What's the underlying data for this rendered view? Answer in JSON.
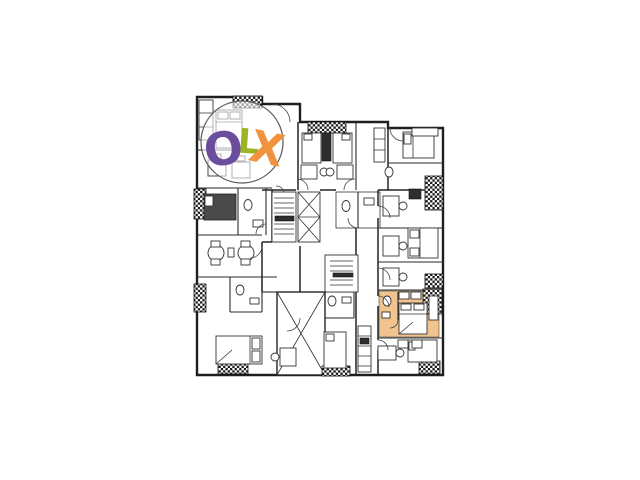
{
  "image": {
    "background": "#ffffff"
  },
  "floorplan": {
    "line_color": "#242424",
    "highlight": {
      "room_fill": "#f1c48f"
    },
    "symbols": {
      "elevator": "x-cross-shaft",
      "stairs": "tread-lines",
      "void": "large-x-cross",
      "service_blocks": "checker-hatch"
    }
  },
  "watermark": {
    "circle_fill": "rgba(255,255,255,0.58)",
    "circle_stroke": "#5a5a5a",
    "letters": [
      {
        "char": "O",
        "color": "#6b4d9e"
      },
      {
        "char": "L",
        "color": "#9ab427"
      },
      {
        "char": "X",
        "color": "#f1923e"
      }
    ]
  }
}
